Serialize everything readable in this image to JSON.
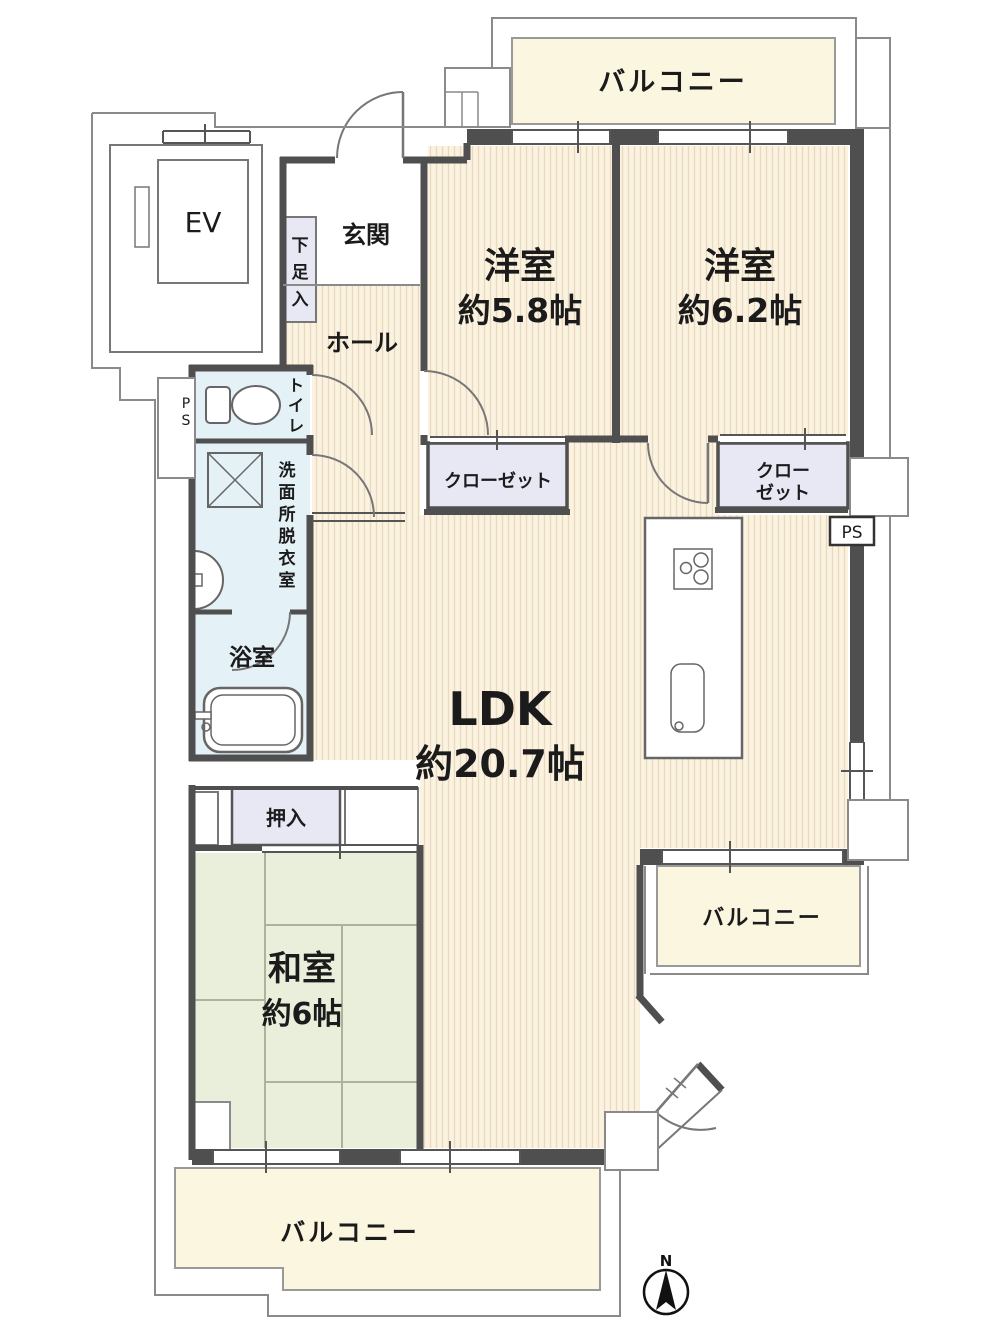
{
  "colors": {
    "flooring_base": "#FBF3E2",
    "flooring_stripe": "#EBD9BD",
    "tatami": "#E9EFDB",
    "tatami_line": "#A9B49A",
    "wet_room": "#E4F1F6",
    "closet": "#E8E7F4",
    "balcony": "#FAF6DF",
    "wall": "#4F4F4F",
    "outline": "#8A8A8A",
    "text": "#1B1B1B"
  },
  "rooms": {
    "western1": {
      "name": "洋室",
      "size": "約5.8帖"
    },
    "western2": {
      "name": "洋室",
      "size": "約6.2帖"
    },
    "ldk": {
      "name": "LDK",
      "size": "約20.7帖"
    },
    "japanese": {
      "name": "和室",
      "size": "約6帖"
    },
    "entrance": {
      "label": "玄関"
    },
    "hall": {
      "label": "ホール"
    },
    "toilet": {
      "label": "トイレ"
    },
    "washroom": {
      "label": "洗面所脱衣室"
    },
    "bathroom": {
      "label": "浴室"
    },
    "oshiire": {
      "label": "押入"
    },
    "closet1": {
      "label": "クローゼット"
    },
    "closet2": {
      "line1": "クロー",
      "line2": "ゼット"
    },
    "shoe_cabinet": {
      "label": "下足入"
    },
    "elevator": {
      "label": "EV"
    }
  },
  "balconies": {
    "top": {
      "label": "バルコニー"
    },
    "right": {
      "label": "バルコニー"
    },
    "bottom": {
      "label": "バルコニー"
    }
  },
  "utilities": {
    "ps_left": {
      "label": "PS"
    },
    "ps_right": {
      "label": "PS"
    }
  },
  "compass": {
    "label": "N"
  }
}
